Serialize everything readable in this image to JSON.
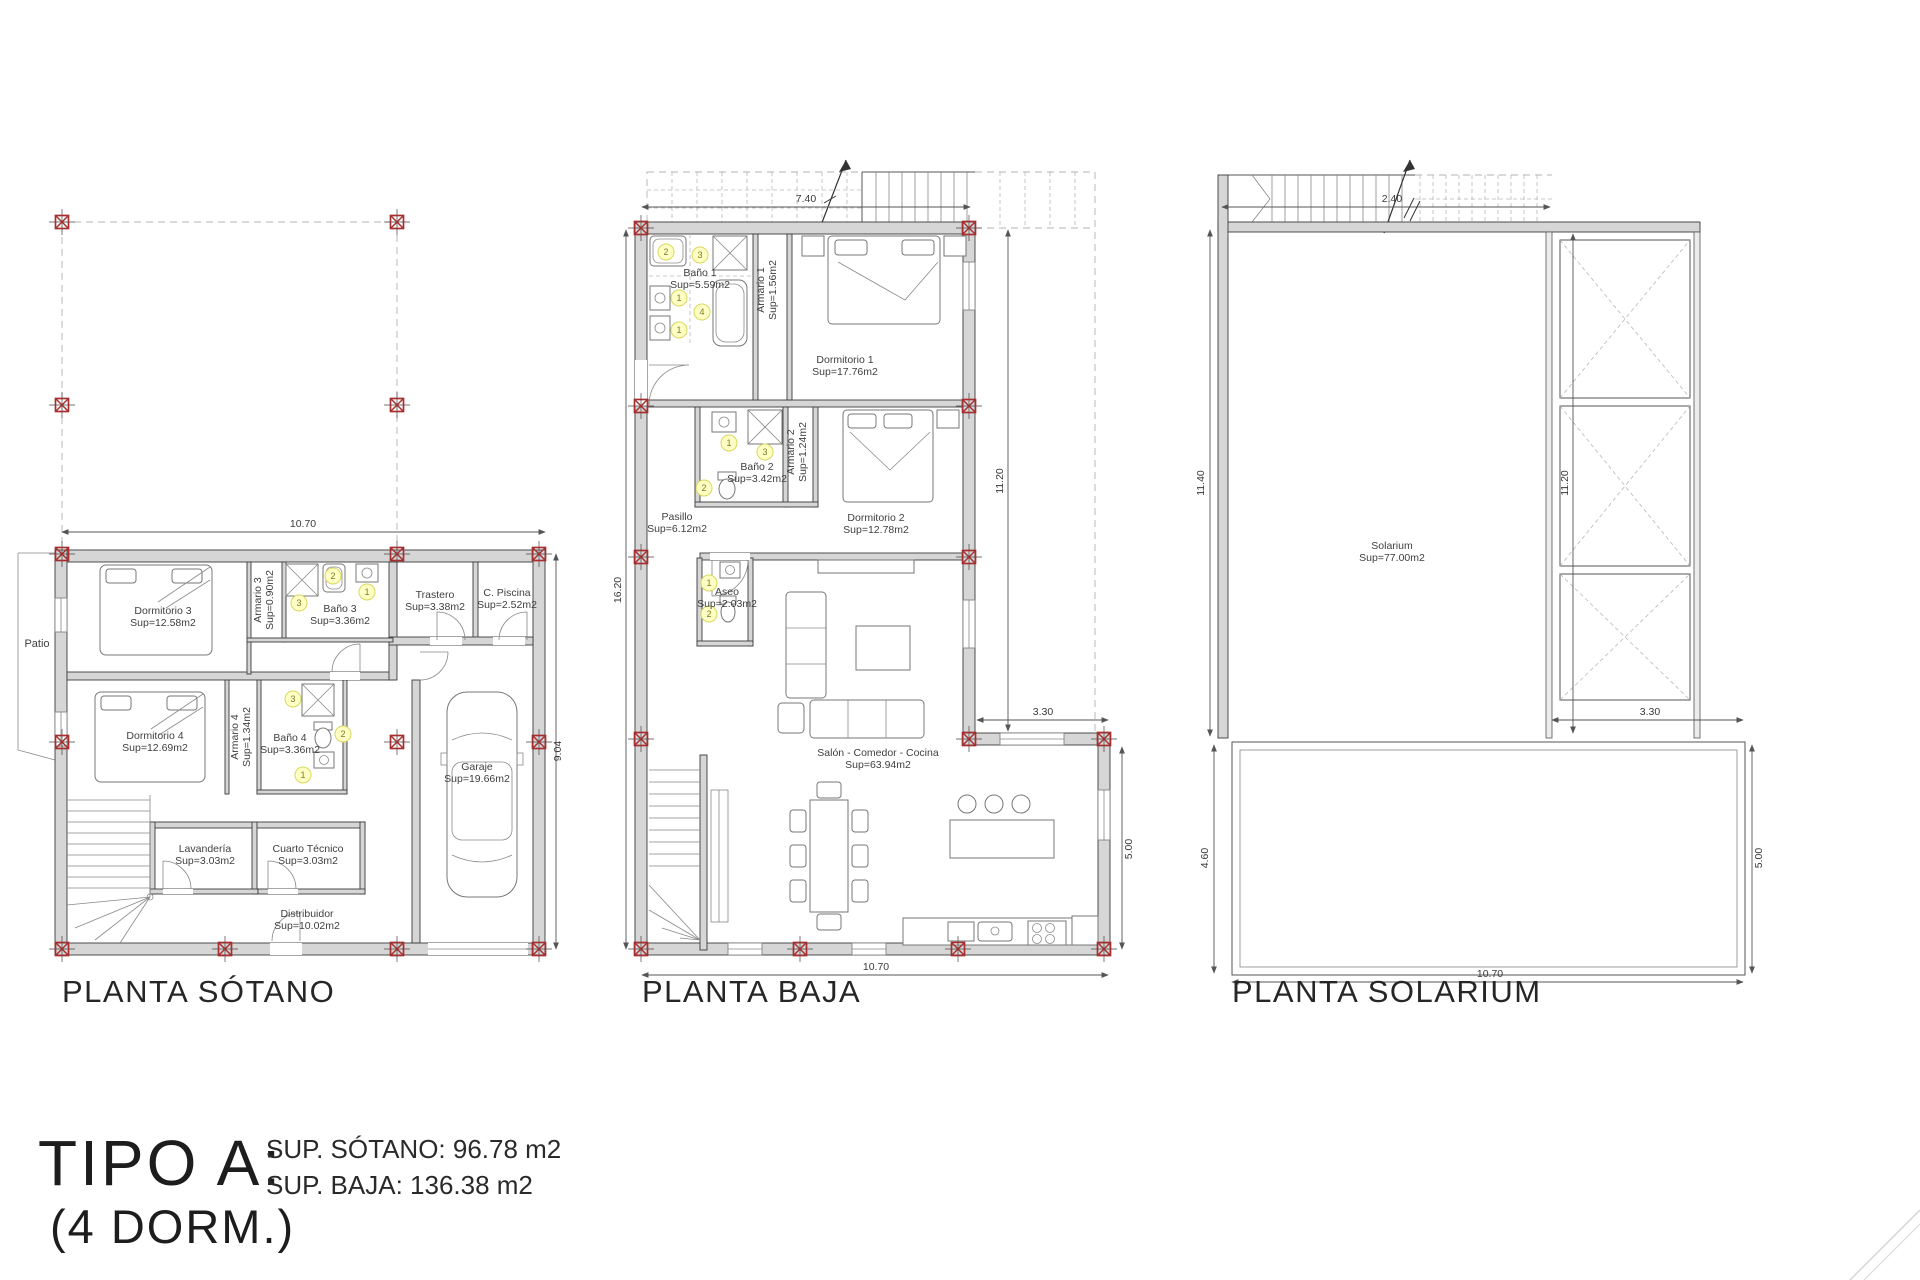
{
  "title_block": {
    "type_label": "TIPO A:",
    "dorm_label": "(4 DORM.)",
    "sup_sotano": "SUP. SÓTANO: 96.78 m2",
    "sup_baja": "SUP. BAJA: 136.38 m2"
  },
  "tags": {
    "n1": "1",
    "n2": "2",
    "n3": "3",
    "n4": "4"
  },
  "colors": {
    "wall": "#d6d6d6",
    "marker_red": "#a52f2f",
    "tag_fill": "#ffffc4",
    "line": "#3c3c3c"
  },
  "plans": {
    "sotano": {
      "name": "PLANTA SÓTANO",
      "patio": "Patio",
      "rooms": {
        "dormitorio3": {
          "name": "Dormitorio 3",
          "sup": "Sup=12.58m2"
        },
        "armario3": {
          "name": "Armario 3",
          "sup": "Sup=0.90m2"
        },
        "bano3": {
          "name": "Baño 3",
          "sup": "Sup=3.36m2"
        },
        "trastero": {
          "name": "Trastero",
          "sup": "Sup=3.38m2"
        },
        "cpiscina": {
          "name": "C. Piscina",
          "sup": "Sup=2.52m2"
        },
        "dormitorio4": {
          "name": "Dormitorio 4",
          "sup": "Sup=12.69m2"
        },
        "armario4": {
          "name": "Armario 4",
          "sup": "Sup=1.34m2"
        },
        "bano4": {
          "name": "Baño 4",
          "sup": "Sup=3.36m2"
        },
        "lavanderia": {
          "name": "Lavandería",
          "sup": "Sup=3.03m2"
        },
        "cuarto": {
          "name": "Cuarto Técnico",
          "sup": "Sup=3.03m2"
        },
        "distribuidor": {
          "name": "Distribuidor",
          "sup": "Sup=10.02m2"
        },
        "garaje": {
          "name": "Garaje",
          "sup": "Sup=19.66m2"
        }
      },
      "dims": {
        "top": "10.70",
        "right": "9.04"
      }
    },
    "baja": {
      "name": "PLANTA BAJA",
      "rooms": {
        "bano1": {
          "name": "Baño 1",
          "sup": "Sup=5.59m2"
        },
        "armario1": {
          "name": "Armario 1",
          "sup": "Sup=1.56m2"
        },
        "dormitorio1": {
          "name": "Dormitorio 1",
          "sup": "Sup=17.76m2"
        },
        "bano2": {
          "name": "Baño 2",
          "sup": "Sup=3.42m2"
        },
        "armario2": {
          "name": "Armario 2",
          "sup": "Sup=1.24m2"
        },
        "dormitorio2": {
          "name": "Dormitorio 2",
          "sup": "Sup=12.78m2"
        },
        "pasillo": {
          "name": "Pasillo",
          "sup": "Sup=6.12m2"
        },
        "aseo": {
          "name": "Aseo",
          "sup": "Sup=2.03m2"
        },
        "salon": {
          "name": "Salón - Comedor - Cocina",
          "sup": "Sup=63.94m2"
        }
      },
      "dims": {
        "top": "7.40",
        "left": "16.20",
        "right": "11.20",
        "inner": "3.30",
        "right_bottom": "5.00",
        "bottom": "10.70"
      }
    },
    "solarium": {
      "name": "PLANTA SOLARIUM",
      "rooms": {
        "solarium": {
          "name": "Solarium",
          "sup": "Sup=77.00m2"
        }
      },
      "dims": {
        "top": "2.40",
        "left": "11.40",
        "right": "11.20",
        "inner": "3.30",
        "left_bottom": "4.60",
        "right_bottom": "5.00",
        "bottom": "10.70"
      }
    }
  }
}
